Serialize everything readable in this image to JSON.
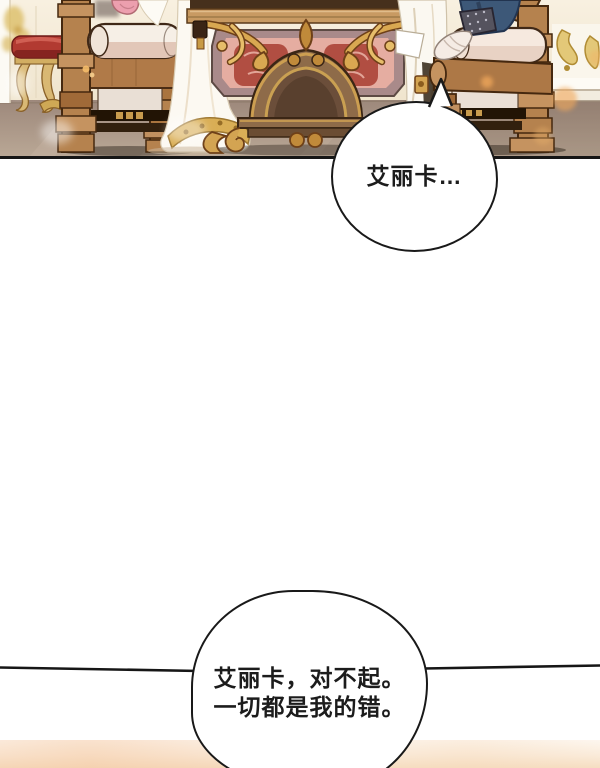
{
  "page": {
    "width_px": 600,
    "height_px": 768,
    "background_color": "#ffffff"
  },
  "panel": {
    "alt": "Palace interior: two ornate wooden armchairs with cream cushions face each other across an elaborately carved gilded table; a figure in a white gown sits at left, a figure in a navy coat with a white gloved hand rests on the right chair arm; a red-cushioned gilt stool stands in the left background.",
    "border_color": "#161616",
    "colors": {
      "wall": "#f5ecdb",
      "floor": "#a8937f",
      "wood": "#b5824e",
      "wood_outline": "#45280f",
      "cushion_cream": "#f6efe6",
      "gold": "#d3a452",
      "carpet_pink": "#e5ada1",
      "carpet_red": "#b14e42",
      "stool_red": "#b23a31",
      "dress_white": "#fcf9f2",
      "sleeve_navy": "#3d5878",
      "bokeh_orange": "#f2a95c"
    }
  },
  "speech": {
    "bubble1": {
      "text": "艾丽卡…"
    },
    "bubble2": {
      "line1": "艾丽卡，对不起。",
      "line2": "一切都是我的错。"
    }
  },
  "divider": {
    "color": "#161616"
  }
}
